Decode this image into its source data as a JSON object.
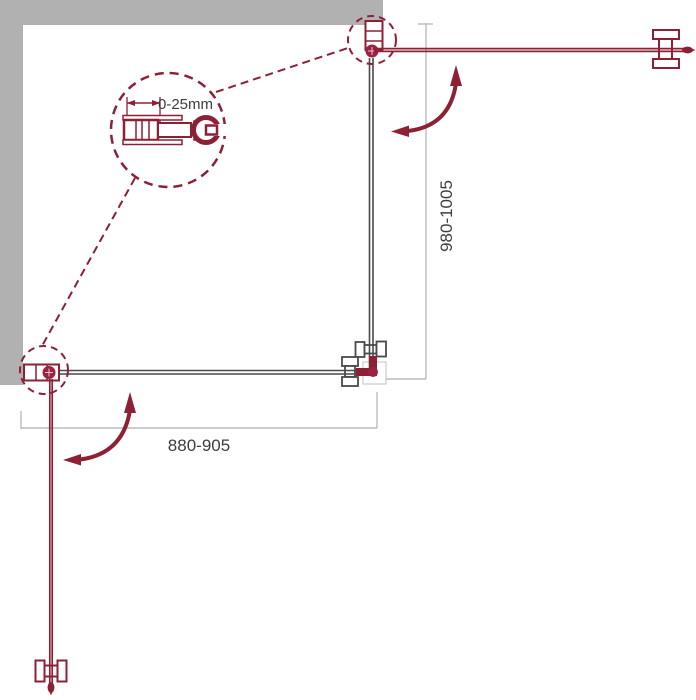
{
  "labels": {
    "detail_adjustment": "0-25mm",
    "depth_dimension": "980-1005",
    "width_dimension": "880-905"
  },
  "colors": {
    "accent_red": "#8E2036",
    "hinge_red": "#9C2242",
    "wall_gray": "#B1B1B1",
    "glass_gray": "#4A4A4A",
    "dimension_gray": "#BBBBBB",
    "label_text": "#3D3D3D",
    "background": "#FFFFFF"
  }
}
